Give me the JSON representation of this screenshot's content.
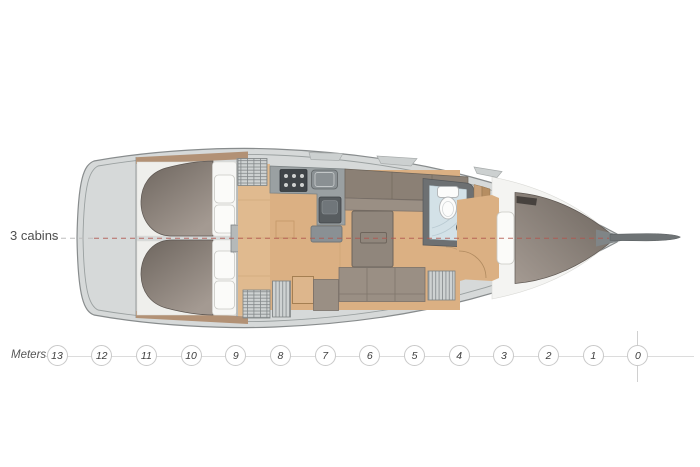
{
  "plan": {
    "cabins_label": "3 cabins"
  },
  "scale": {
    "label": "Meters",
    "marks": [
      "13",
      "12",
      "11",
      "10",
      "9",
      "8",
      "7",
      "6",
      "5",
      "4",
      "3",
      "2",
      "1",
      "0"
    ]
  },
  "colors": {
    "background": "#ffffff",
    "hull_fill": "#d6d9d9",
    "hull_stroke": "#888c8d",
    "inner_line": "#9aa0a0",
    "wood_light": "#e0ba8f",
    "wood_mid": "#dbb083",
    "wood_trim": "#b29175",
    "berth_dark": "#6e665f",
    "berth_light": "#a49a92",
    "furniture_taupe": "#9a8f84",
    "cabinetry": "#8b8075",
    "counter_gray": "#9aa0a2",
    "appliance_dark": "#3f4448",
    "hatch_bg": "#ced2d2",
    "hatch_line": "#83888a",
    "head_wall": "#6d7072",
    "head_floor": "#d3e1e7",
    "cushion_white": "#f6f6f4",
    "centerline_red": "#b2564d",
    "centerline_gray": "#bdbdbd",
    "scale_line": "#dcdcdc",
    "scale_circle_border": "#c9c9c9",
    "scale_text": "#3f3f3f",
    "label_text": "#4f4f4f",
    "bowsprit": "#6e7375"
  }
}
